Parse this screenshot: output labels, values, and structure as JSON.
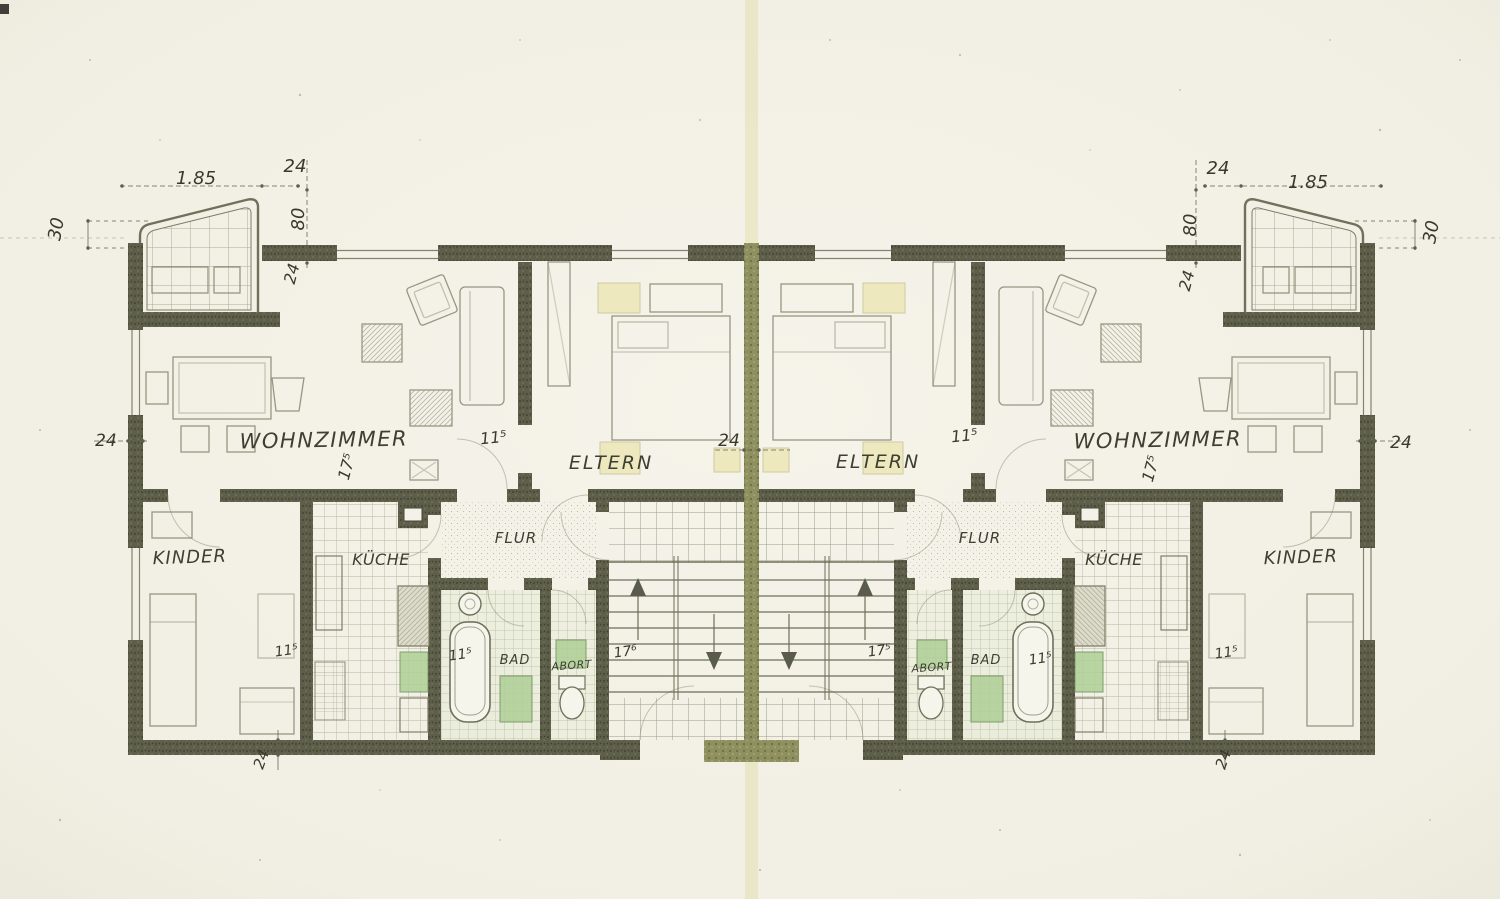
{
  "units": {
    "left": {
      "wohnzimmer": "WOHNZIMMER",
      "eltern": "ELTERN",
      "kinder": "KINDER",
      "kueche": "KÜCHE",
      "flur": "FLUR",
      "bad": "BAD",
      "abort": "ABORT"
    },
    "right": {
      "wohnzimmer": "WOHNZIMMER",
      "eltern": "ELTERN",
      "kinder": "KINDER",
      "kueche": "KÜCHE",
      "flur": "FLUR",
      "bad": "BAD",
      "abort": "ABORT"
    }
  },
  "annotations": [
    {
      "id": "tl-185",
      "value": "1.85"
    },
    {
      "id": "tl-24",
      "value": "24"
    },
    {
      "id": "tl-80",
      "value": "80"
    },
    {
      "id": "tl-24b",
      "value": "24"
    },
    {
      "id": "tl-30",
      "value": "30"
    },
    {
      "id": "tr-24",
      "value": "24"
    },
    {
      "id": "tr-185",
      "value": "1.85"
    },
    {
      "id": "tr-80",
      "value": "80"
    },
    {
      "id": "tr-24b",
      "value": "24"
    },
    {
      "id": "tr-30",
      "value": "30"
    },
    {
      "id": "left-edge-24",
      "value": "24"
    },
    {
      "id": "right-edge-24",
      "value": "24"
    },
    {
      "id": "center-24",
      "value": "24"
    },
    {
      "id": "l-wohn-115",
      "value": "11⁵"
    },
    {
      "id": "r-wohn-115",
      "value": "11⁵"
    },
    {
      "id": "l-wohn-175",
      "value": "17⁵"
    },
    {
      "id": "r-wohn-175",
      "value": "17⁵"
    },
    {
      "id": "l-kinder-115",
      "value": "11⁵"
    },
    {
      "id": "r-kinder-115",
      "value": "11⁵"
    },
    {
      "id": "l-bad-115",
      "value": "11⁵"
    },
    {
      "id": "r-bad-115",
      "value": "11⁵"
    },
    {
      "id": "l-stair-176",
      "value": "17⁶"
    },
    {
      "id": "r-stair-175",
      "value": "17⁵"
    },
    {
      "id": "bl-24",
      "value": "24"
    },
    {
      "id": "br-24",
      "value": "24"
    }
  ],
  "colors": {
    "wall_dark": "#5d5f4a",
    "party_wall": "#8f9060",
    "paper": "#f2f0e5",
    "fixture_green": "#aecf96",
    "highlight_yellow": "#eae3a5",
    "ink": "#3d3f32"
  }
}
